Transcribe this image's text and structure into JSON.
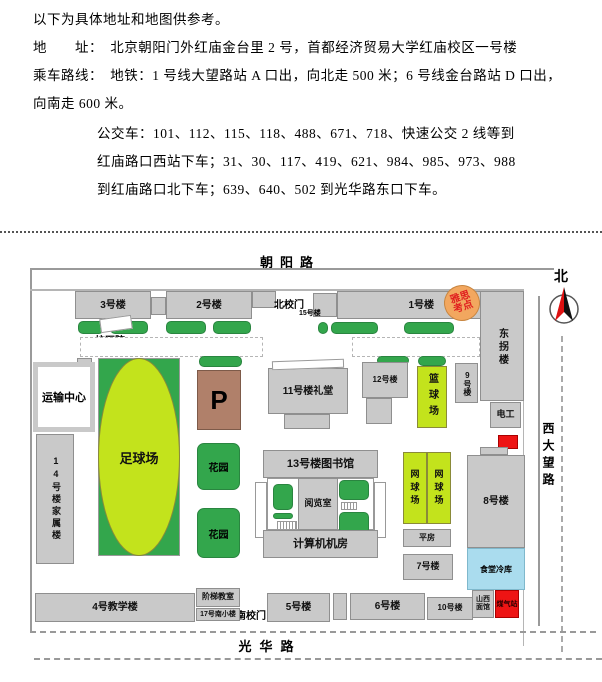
{
  "intro": {
    "l1": "以下为具体地址和地图供参考。",
    "l2": "地　　址：　北京朝阳门外红庙金台里 2 号，首都经济贸易大学红庙校区一号楼",
    "l3": "乘车路线：　地铁：1 号线大望路站 A 口出，向北走 500 米；6 号线金台路站 D 口出，",
    "l4": "向南走 600 米。",
    "l5": "公交车：101、112、115、118、488、671、718、快速公交 2 线等到",
    "l6": "红庙路口西站下车；31、30、117、419、621、984、985、973、988",
    "l7": "到红庙路口北下车；639、640、502 到光华路东口下车。"
  },
  "map": {
    "roads": {
      "top": "朝阳路",
      "bottom": "光华路",
      "right": "西大望路",
      "north": "北"
    },
    "badge": {
      "l1": "雅思",
      "l2": "考点"
    },
    "b": {
      "b3": "3号楼",
      "b2": "2号楼",
      "north_gate": "北校门",
      "b15": "15号楼",
      "b1": "1号楼",
      "east_wing": "东拐楼",
      "clinic": "校医院",
      "transport": "运输中心",
      "b14": "14号楼家属楼",
      "football": "足球场",
      "parking": "P",
      "garden1": "花园",
      "garden2": "花园",
      "b11": "11号楼礼堂",
      "b12": "12号楼",
      "basketball": "篮球场",
      "b9": "9号楼",
      "electric": "电工",
      "b13": "13号楼图书馆",
      "reading": "阅览室",
      "computer": "计算机机房",
      "tennis1": "网球场",
      "tennis2": "网球场",
      "pingfang": "平房",
      "b7": "7号楼",
      "b8": "8号楼",
      "cold": "食堂冷库",
      "noodle_l1": "山西",
      "noodle_l2": "面馆",
      "gas": "煤气站",
      "b10": "10号楼",
      "b6": "6号楼",
      "b5": "5号楼",
      "south_gate": "南校门",
      "stair_room": "阶梯教室",
      "b17": "17号南小楼",
      "b4": "4号教学楼"
    },
    "colors": {
      "building_gray": "#c9c9c9",
      "bush_green": "#33a64c",
      "court_green": "#c3e31c",
      "parking_brown": "#b0806a",
      "badge_orange": "#f2a75f",
      "badge_text_red": "#e02020",
      "alert_red": "#ee1414",
      "cold_blue": "#aadcee"
    }
  }
}
